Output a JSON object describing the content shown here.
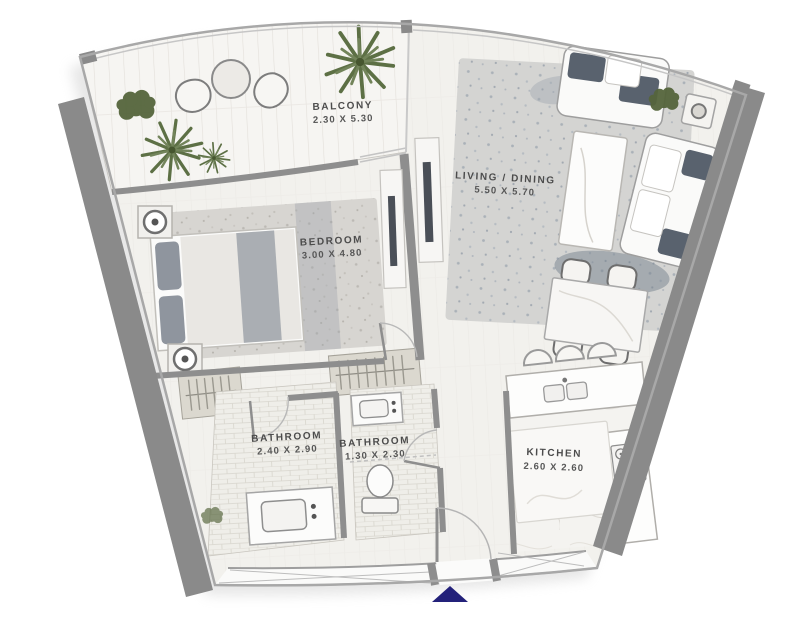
{
  "floorplan": {
    "rooms": {
      "balcony": {
        "label": "BALCONY",
        "dimensions": "2.30 X 5.30"
      },
      "living_dining": {
        "label": "LIVING / DINING",
        "dimensions": "5.50 X 5.70"
      },
      "bedroom": {
        "label": "BEDROOM",
        "dimensions": "3.00 X 4.80"
      },
      "bathroom_main": {
        "label": "BATHROOM",
        "dimensions": "2.40 X 2.90"
      },
      "bathroom_guest": {
        "label": "BATHROOM",
        "dimensions": "1.30 X 2.30"
      },
      "kitchen": {
        "label": "KITCHEN",
        "dimensions": "2.60 X 2.60"
      }
    },
    "colors": {
      "wall": "#8e8e8e",
      "exterior_wall": "#8a8a8a",
      "floor": "#f0efeb",
      "balcony_deck": "#f6f5f2",
      "bath_tile": "#efeee9",
      "rug": "#d7d5d1",
      "sofa_cushion": "#59626e",
      "greenery": "#5d7045",
      "entrance_marker": "#23217a",
      "label_text": "#4c4c4c"
    },
    "markers": {
      "entrance_arrow": "entrance-direction-arrow"
    }
  }
}
